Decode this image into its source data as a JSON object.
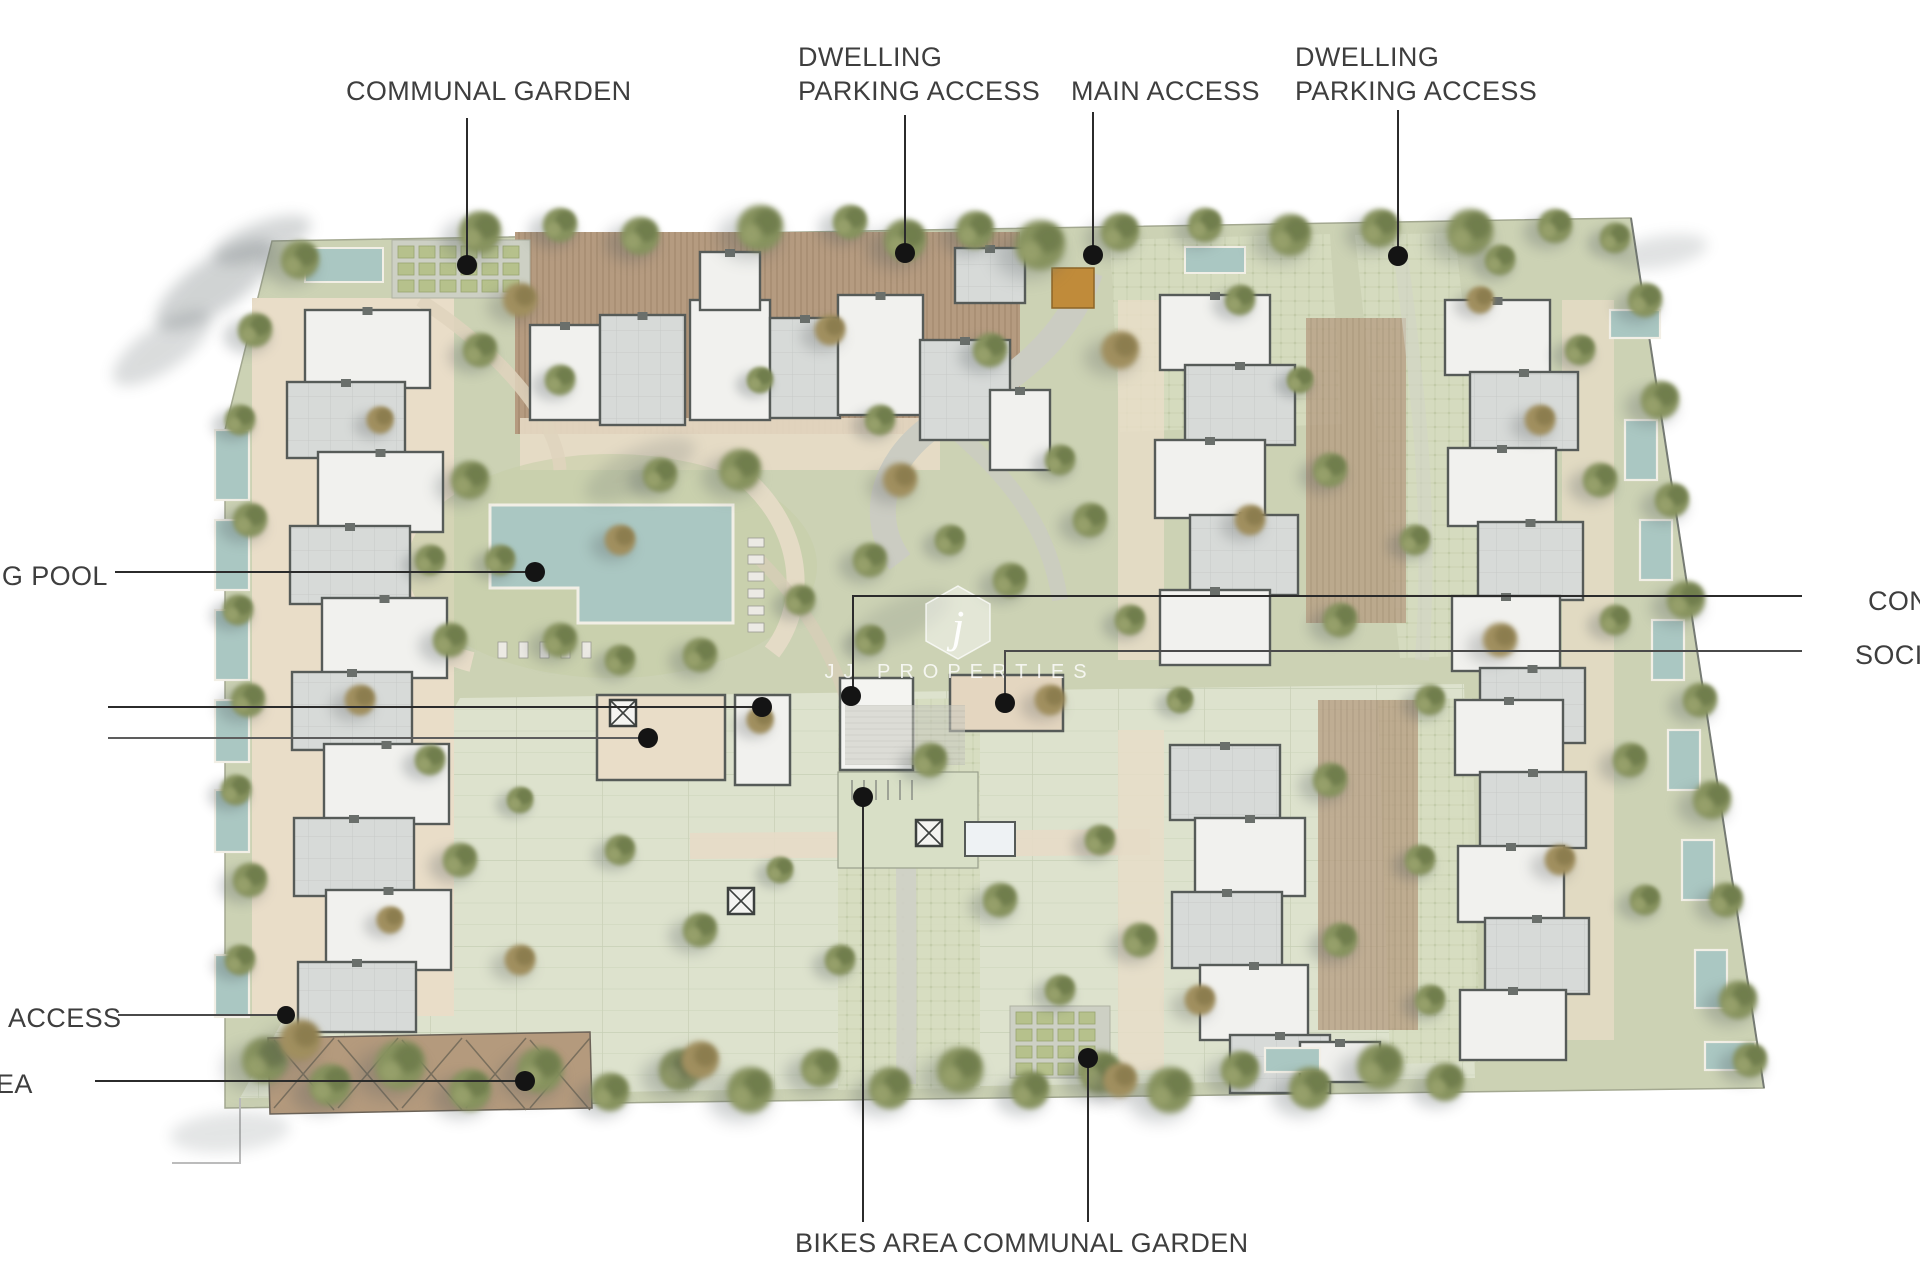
{
  "plan": {
    "kind": "residential masterplan site plan",
    "watermark": {
      "logo_letter": "j",
      "brand": "JJ PROPERTIES"
    }
  },
  "callouts": {
    "communal_garden_top": {
      "label": "COMMUNAL GARDEN"
    },
    "dwelling_parking_left": {
      "line1": "DWELLING",
      "line2": "PARKING ACCESS"
    },
    "main_access": {
      "label": "MAIN ACCESS"
    },
    "dwelling_parking_right": {
      "line1": "DWELLING",
      "line2": "PARKING ACCESS"
    },
    "swimming_pool_truncated": {
      "label": "NG POOL"
    },
    "concierge_truncated": {
      "label": "CON"
    },
    "social_truncated": {
      "label": "SOCIA"
    },
    "access_truncated": {
      "label": "ACCESS"
    },
    "area_truncated": {
      "label": "EA"
    },
    "bikes_area": {
      "label": "BIKES AREA"
    },
    "communal_garden_bottom": {
      "label": "COMMUNAL GARDEN"
    }
  },
  "colors": {
    "background": "#ffffff",
    "site_green": "#ccd2b4",
    "parking_deck_green": "#dde2cd",
    "path_beige": "#e8dcc8",
    "deck_brown": "#b59b80",
    "roof_white": "#f1f1ee",
    "roof_gray": "#d7dad8",
    "building_outline": "#565b58",
    "pool_blue": "#aac7c2",
    "main_access_orange": "#c08b3a",
    "tree_green": "#87935f",
    "label_text": "#3e3e3e",
    "leader_line": "#2b2b2b"
  }
}
